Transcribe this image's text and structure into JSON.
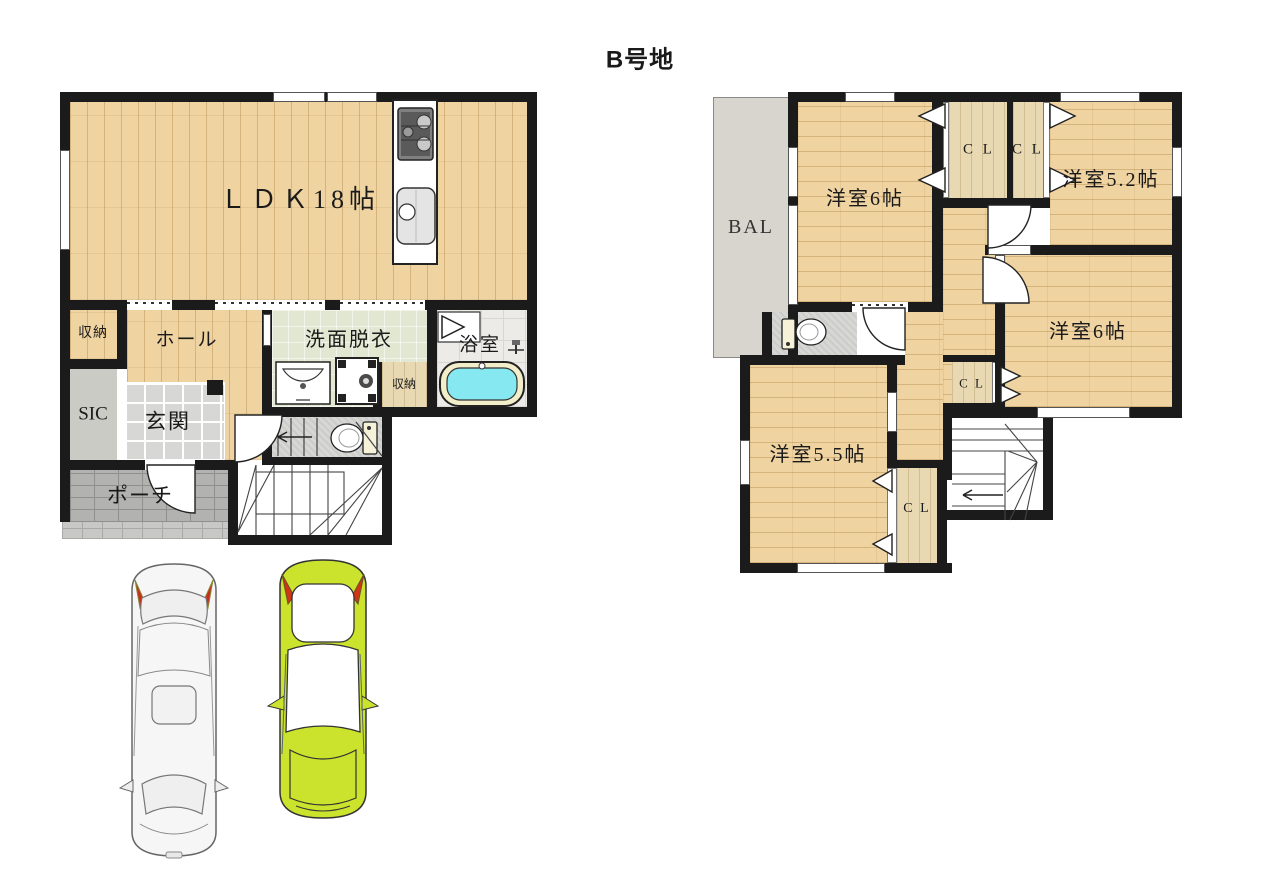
{
  "title": "B号地",
  "floor1": {
    "rooms": {
      "ldk": "ＬＤＫ18帖",
      "storage_top": "収納",
      "hall": "ホール",
      "washroom": "洗面脱衣",
      "bath": "浴室",
      "storage_small": "収納",
      "sic": "SIC",
      "genkan": "玄関",
      "porch": "ポーチ"
    }
  },
  "floor2": {
    "rooms": {
      "balcony": "BAL",
      "bedroom_top_left": "洋室6帖",
      "closet_a": "C L",
      "closet_b": "C L",
      "bedroom_top_right": "洋室5.2帖",
      "bedroom_right": "洋室6帖",
      "closet_mid": "C L",
      "bedroom_bottom_left": "洋室5.5帖",
      "closet_bottom": "C L"
    }
  },
  "cars": {
    "left": "white-sedan",
    "right": "lime-compact"
  },
  "colors": {
    "wall": "#1b1b1b",
    "wood": "#efd3a1",
    "washroom_green": "#e1e7d0",
    "bathtub_cyan": "#86e9f2",
    "car_lime": "#cbe32d",
    "balcony_gray": "#d7d5cd"
  }
}
